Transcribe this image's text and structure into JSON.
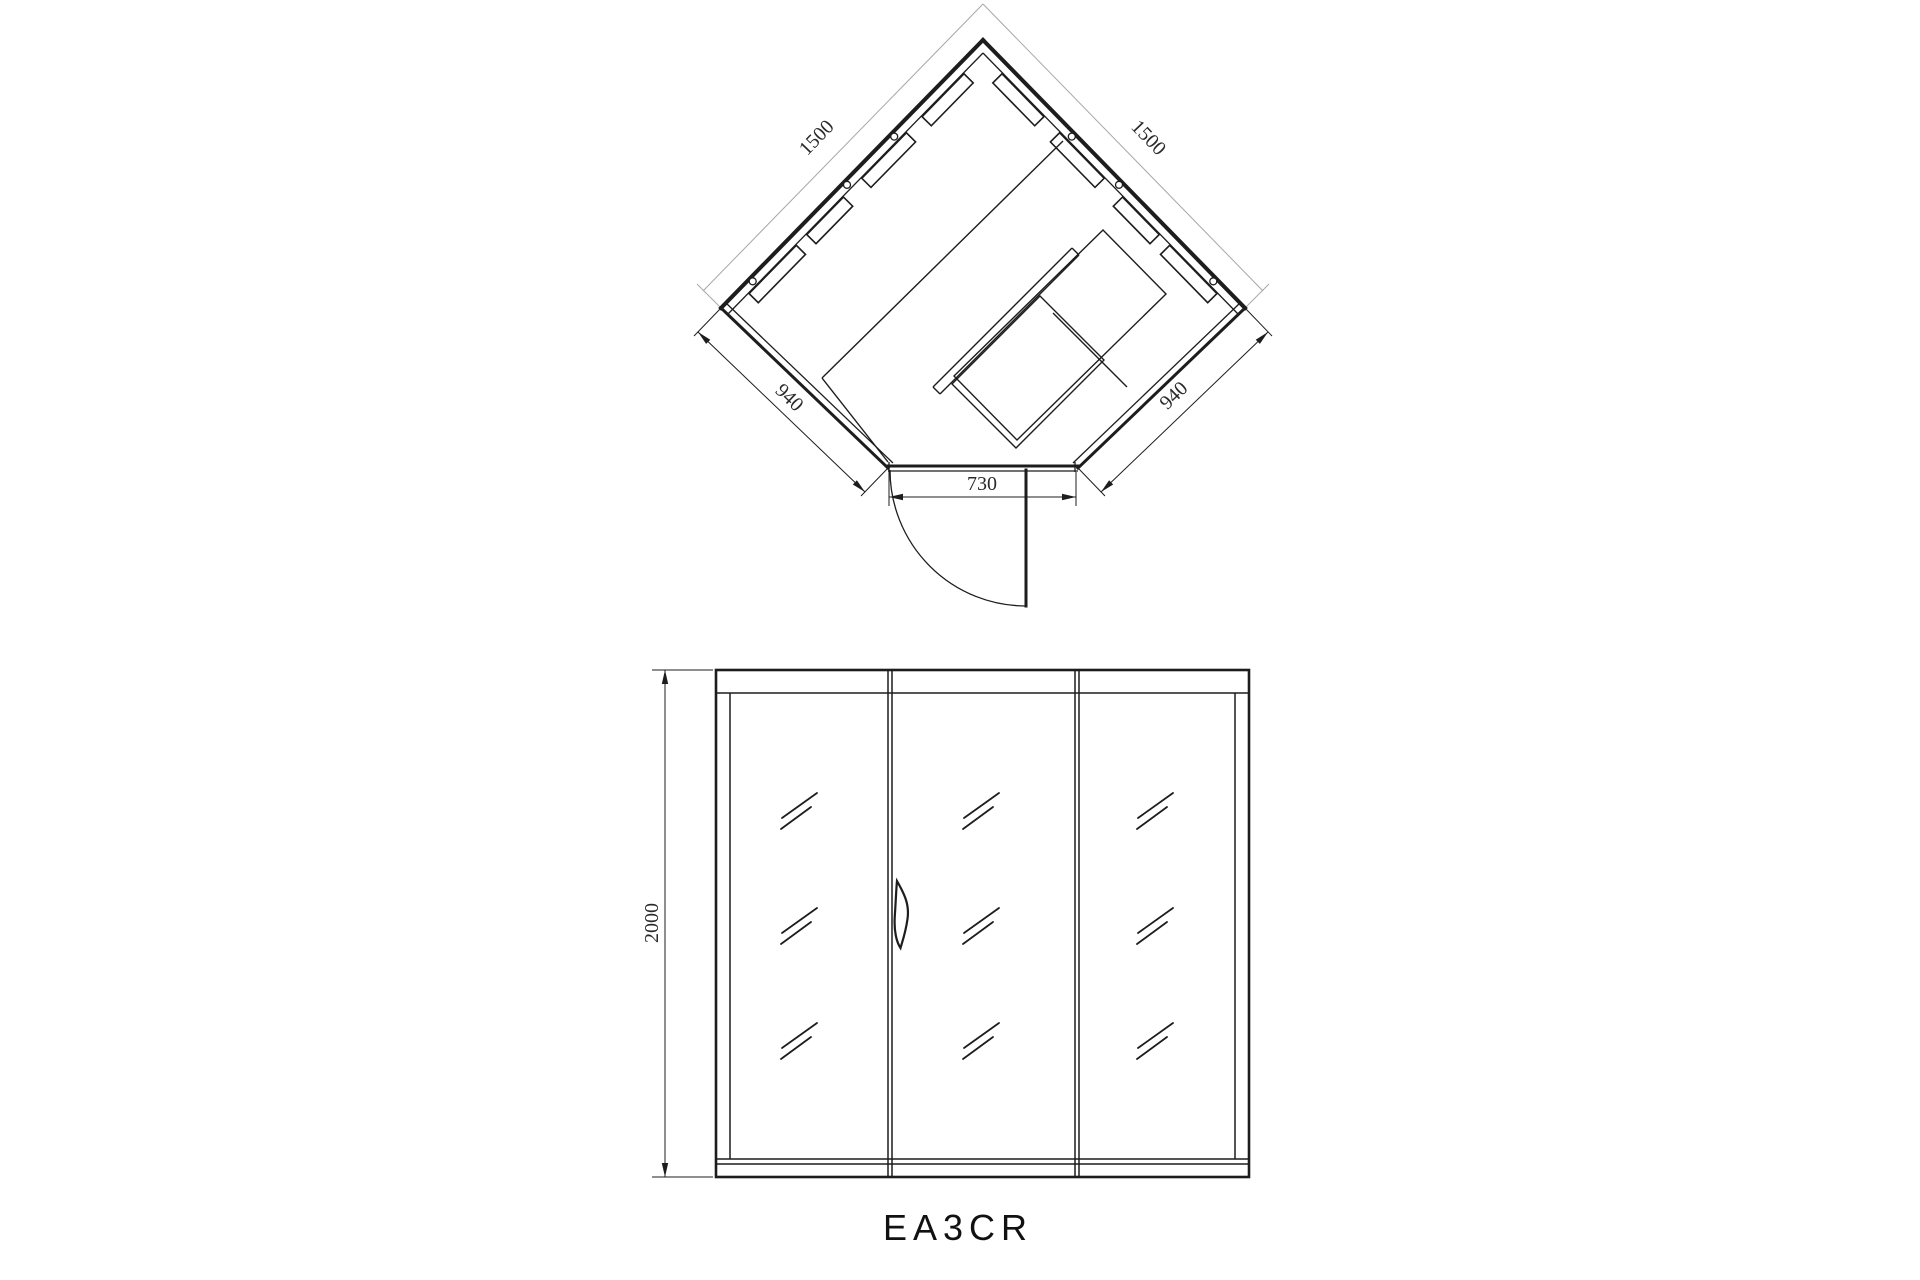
{
  "drawing": {
    "model_label": "EA3CR",
    "plan_view": {
      "dim_wall_left": "1500",
      "dim_wall_right": "1500",
      "dim_front_left": "940",
      "dim_front_right": "940",
      "dim_door_width": "730"
    },
    "elevation_view": {
      "dim_height": "2000"
    },
    "colors": {
      "line": "#1d1d1d",
      "dim_light_line": "#a8a8a8",
      "background": "#ffffff"
    }
  }
}
